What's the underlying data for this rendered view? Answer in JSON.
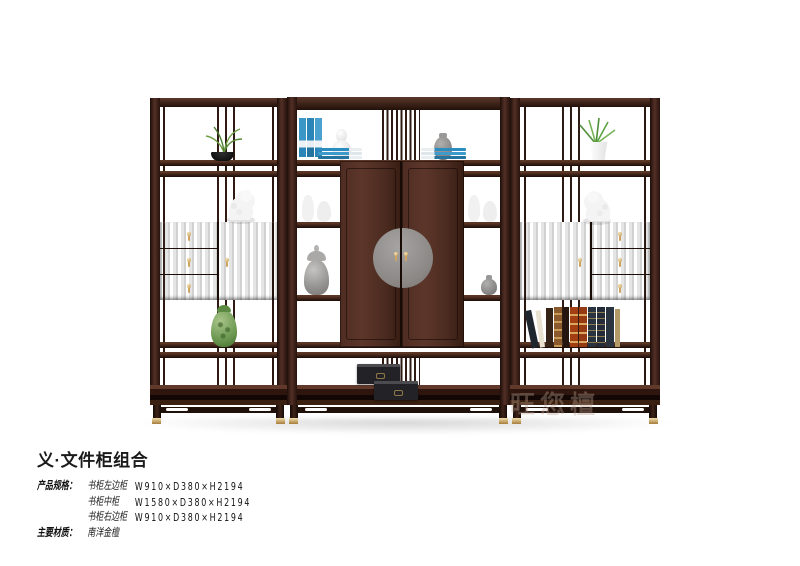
{
  "caption": {
    "title": "义·文件柜组合",
    "specs_label": "产品规格：",
    "specs": [
      {
        "item": "书柜左边柜",
        "size": "W910×D380×H2194"
      },
      {
        "item": "书柜中柜",
        "size": "W1580×D380×H2194"
      },
      {
        "item": "书柜右边柜",
        "size": "W910×D380×H2194"
      }
    ],
    "material_label": "主要材质：",
    "material": "南洋金檀"
  },
  "photo": {
    "watermark": "旺您檀",
    "colors": {
      "wood_dark": "#27130d",
      "wood_mid": "#4a2a1f",
      "wood_light": "#5f3a2c",
      "brass": "#cfa45f",
      "plate_gray": "#8b8886",
      "book_blue": "#2b8cc0",
      "vase_green": "#6f9c55",
      "box_black": "#232327",
      "background": "#ffffff"
    }
  }
}
